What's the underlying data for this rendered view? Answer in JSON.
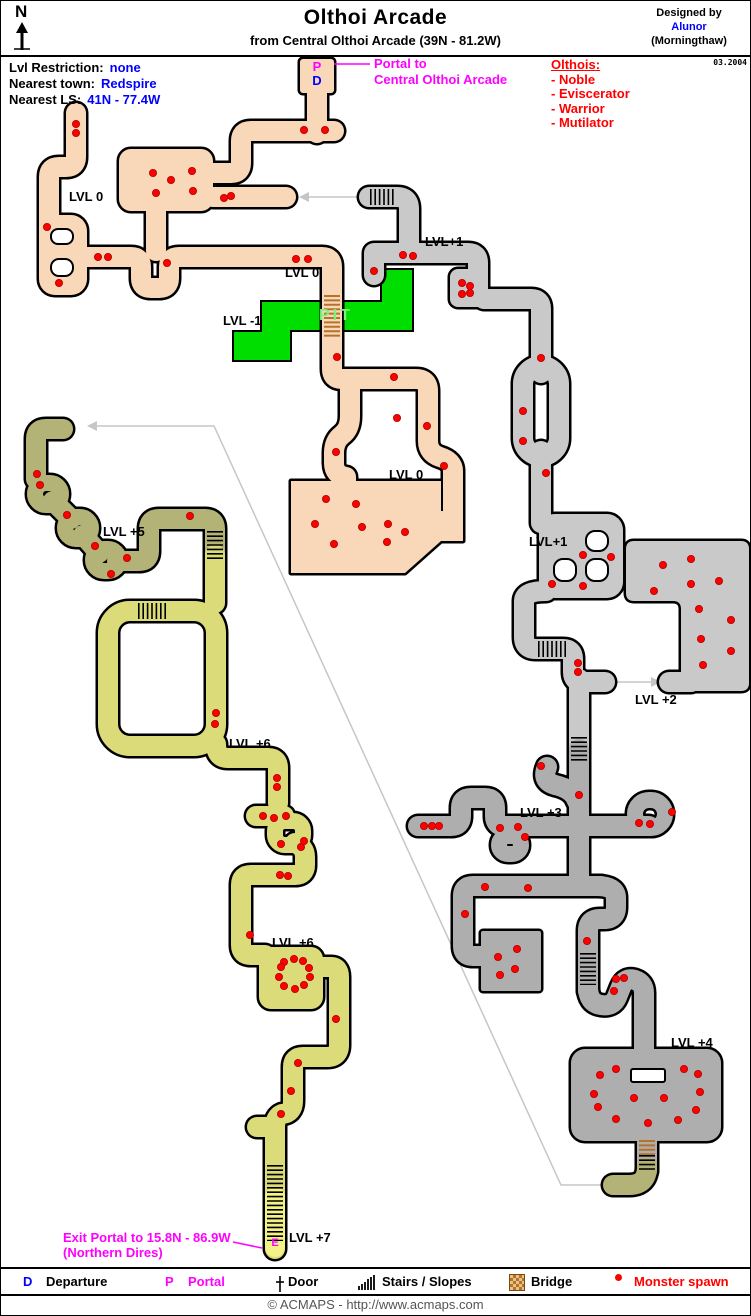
{
  "header": {
    "title": "Olthoi Arcade",
    "subtitle": "from Central Olthoi Arcade (39N - 81.2W)",
    "designed_by": "Designed by",
    "designer": "Alunor",
    "designer_world": "(Morningthaw)",
    "date": "03.2004",
    "compass": "N"
  },
  "info": {
    "restriction_label": "Lvl Restriction:",
    "restriction_value": "none",
    "town_label": "Nearest town:",
    "town_value": "Redspire",
    "ls_label": "Nearest LS:",
    "ls_value": "41N - 77.4W"
  },
  "olthois": {
    "heading": "Olthois:",
    "items": [
      "- Noble",
      "- Eviscerator",
      "- Warrior",
      "- Mutilator"
    ]
  },
  "annotations": {
    "portal_line1": "Portal to",
    "portal_line2": "Central Olthoi Arcade",
    "exit_line1": "Exit Portal to 15.8N - 86.9W",
    "exit_line2": "(Northern Dires)",
    "portal_marker": "P",
    "departure_marker": "D",
    "exit_marker": "E",
    "pit": "PIT"
  },
  "map": {
    "labels": {
      "lvl0_nw": "LVL 0",
      "lvl0_top": "LVL 0",
      "lvl_minus1": "LVL -1",
      "lvl1_top": "LVL+1",
      "lvl0_mid": "LVL 0",
      "lvl1_right": "LVL+1",
      "lvl5": "LVL +5",
      "lvl2": "LVL +2",
      "lvl6_upper": "LVL +6",
      "lvl3": "LVL +3",
      "lvl6_room": "LVL +6",
      "lvl4": "LVL +4",
      "lvl7": "LVL +7"
    },
    "spawns": [
      [
        75,
        123
      ],
      [
        75,
        132
      ],
      [
        303,
        129
      ],
      [
        324,
        129
      ],
      [
        46,
        226
      ],
      [
        97,
        256
      ],
      [
        107,
        256
      ],
      [
        58,
        282
      ],
      [
        166,
        262
      ],
      [
        152,
        172
      ],
      [
        170,
        179
      ],
      [
        191,
        170
      ],
      [
        192,
        190
      ],
      [
        155,
        192
      ],
      [
        223,
        197
      ],
      [
        230,
        195
      ],
      [
        295,
        258
      ],
      [
        307,
        258
      ],
      [
        336,
        356
      ],
      [
        393,
        376
      ],
      [
        396,
        417
      ],
      [
        426,
        425
      ],
      [
        335,
        451
      ],
      [
        443,
        465
      ],
      [
        325,
        498
      ],
      [
        355,
        503
      ],
      [
        314,
        523
      ],
      [
        361,
        526
      ],
      [
        387,
        523
      ],
      [
        404,
        531
      ],
      [
        386,
        541
      ],
      [
        333,
        543
      ],
      [
        373,
        270
      ],
      [
        402,
        254
      ],
      [
        412,
        255
      ],
      [
        461,
        282
      ],
      [
        469,
        285
      ],
      [
        461,
        293
      ],
      [
        469,
        292
      ],
      [
        540,
        357
      ],
      [
        522,
        410
      ],
      [
        522,
        440
      ],
      [
        545,
        472
      ],
      [
        582,
        554
      ],
      [
        610,
        556
      ],
      [
        551,
        583
      ],
      [
        582,
        585
      ],
      [
        577,
        662
      ],
      [
        577,
        671
      ],
      [
        662,
        564
      ],
      [
        690,
        558
      ],
      [
        718,
        580
      ],
      [
        690,
        583
      ],
      [
        653,
        590
      ],
      [
        698,
        608
      ],
      [
        730,
        619
      ],
      [
        700,
        638
      ],
      [
        730,
        650
      ],
      [
        702,
        664
      ],
      [
        540,
        765
      ],
      [
        578,
        794
      ],
      [
        423,
        825
      ],
      [
        431,
        825
      ],
      [
        438,
        825
      ],
      [
        499,
        827
      ],
      [
        517,
        826
      ],
      [
        524,
        836
      ],
      [
        638,
        822
      ],
      [
        649,
        823
      ],
      [
        671,
        811
      ],
      [
        484,
        886
      ],
      [
        527,
        887
      ],
      [
        464,
        913
      ],
      [
        497,
        956
      ],
      [
        516,
        948
      ],
      [
        514,
        968
      ],
      [
        499,
        974
      ],
      [
        586,
        940
      ],
      [
        615,
        978
      ],
      [
        623,
        977
      ],
      [
        613,
        990
      ],
      [
        599,
        1074
      ],
      [
        615,
        1068
      ],
      [
        683,
        1068
      ],
      [
        697,
        1073
      ],
      [
        593,
        1093
      ],
      [
        699,
        1091
      ],
      [
        597,
        1106
      ],
      [
        695,
        1109
      ],
      [
        633,
        1097
      ],
      [
        663,
        1097
      ],
      [
        615,
        1118
      ],
      [
        677,
        1119
      ],
      [
        647,
        1122
      ],
      [
        36,
        473
      ],
      [
        39,
        484
      ],
      [
        66,
        514
      ],
      [
        94,
        545
      ],
      [
        126,
        557
      ],
      [
        110,
        573
      ],
      [
        189,
        515
      ],
      [
        215,
        712
      ],
      [
        214,
        723
      ],
      [
        276,
        777
      ],
      [
        276,
        786
      ],
      [
        262,
        815
      ],
      [
        273,
        817
      ],
      [
        285,
        815
      ],
      [
        280,
        843
      ],
      [
        300,
        846
      ],
      [
        303,
        840
      ],
      [
        279,
        874
      ],
      [
        287,
        875
      ],
      [
        249,
        934
      ],
      [
        283,
        961
      ],
      [
        293,
        958
      ],
      [
        302,
        960
      ],
      [
        308,
        967
      ],
      [
        309,
        976
      ],
      [
        303,
        984
      ],
      [
        294,
        988
      ],
      [
        283,
        985
      ],
      [
        278,
        976
      ],
      [
        280,
        966
      ],
      [
        335,
        1018
      ],
      [
        297,
        1062
      ],
      [
        290,
        1090
      ],
      [
        280,
        1113
      ]
    ]
  },
  "legend": {
    "departure_key": "D",
    "departure": "Departure",
    "portal_key": "P",
    "portal": "Portal",
    "door": "Door",
    "stairs": "Stairs / Slopes",
    "bridge": "Bridge",
    "monster": "Monster spawn"
  },
  "footer": {
    "copyright": "© ACMAPS - http://www.acmaps.com"
  },
  "colors": {
    "peach": "#F8D8B8",
    "gray_light": "#C9C9C9",
    "gray_dark": "#AEAEAE",
    "olive": "#B3B377",
    "yellow": "#DBDB7A",
    "yellow_bright": "#F2F288",
    "pit_green": "#00DE00",
    "pit_text": "#7FEF7F",
    "magenta": "#FF00FF",
    "blue": "#0000FF",
    "red": "#FF0000",
    "connector": "#C6C6C6"
  }
}
